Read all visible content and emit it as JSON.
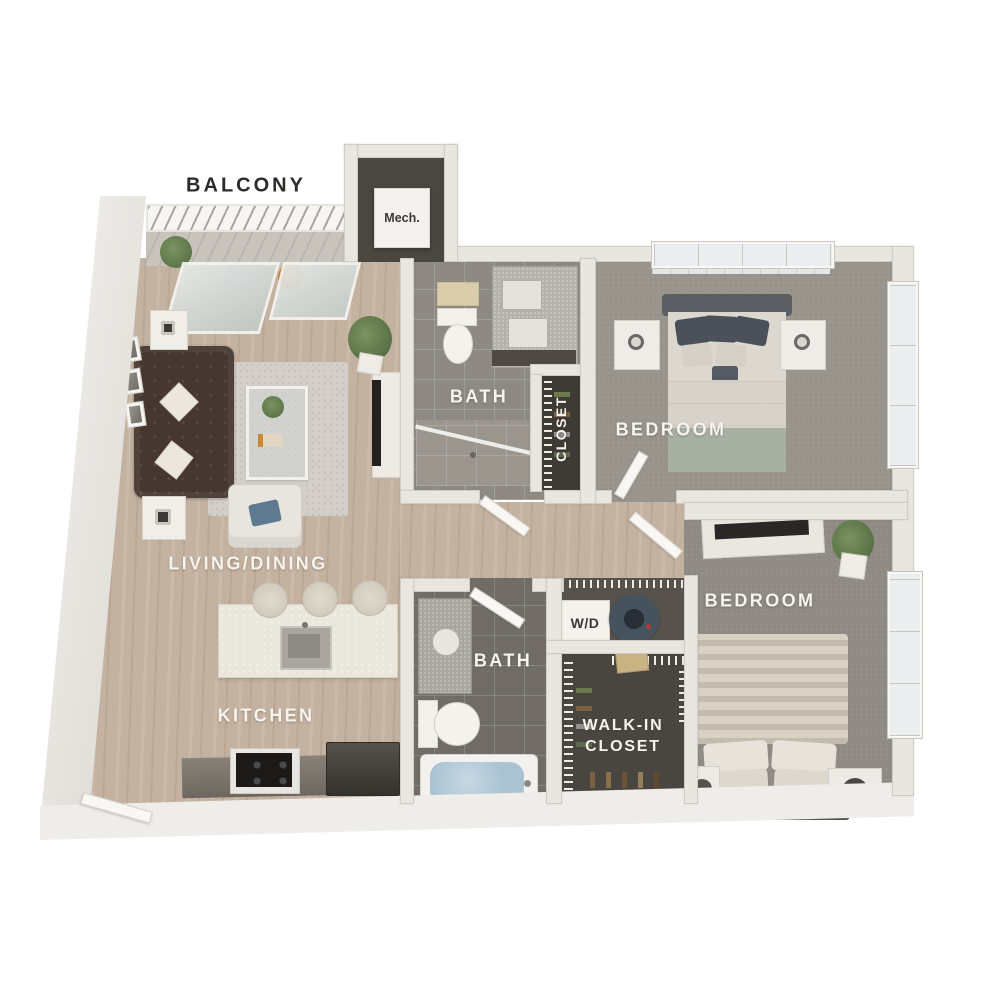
{
  "plan": {
    "labels": {
      "balcony": "BALCONY",
      "mech": "Mech.",
      "bath_upper": "BATH",
      "closet_upper": "CLOSET",
      "bedroom_upper": "BEDROOM",
      "living_dining": "LIVING/DINING",
      "kitchen": "KITCHEN",
      "bath_lower": "BATH",
      "washer_dryer": "W/D",
      "walk_in_line1": "WALK-IN",
      "walk_in_line2": "CLOSET",
      "bedroom_lower": "BEDROOM"
    },
    "colors": {
      "background": "#ffffff",
      "wall": "#e9e6e0",
      "wood_floor": "#c4b2a0",
      "carpet": "#98938b",
      "carpet_dark": "#8f8a83",
      "tile_upper_bath": "#8e8a83",
      "tile_lower_bath": "#716d66",
      "closet_floor": "#3e3b36",
      "walkin_floor": "#494641",
      "wd_floor": "#57534c",
      "label_light": "#f7f4ee",
      "label_dark": "#2d2b28",
      "tub_water": "#a9c3d3",
      "sofa": "#463831",
      "rug": "#d3cfc8",
      "island": "#eae7dd",
      "counter": "#7e766d",
      "plant": "#66814f",
      "washer": "#46525e",
      "glass": "#dde3e1"
    }
  }
}
